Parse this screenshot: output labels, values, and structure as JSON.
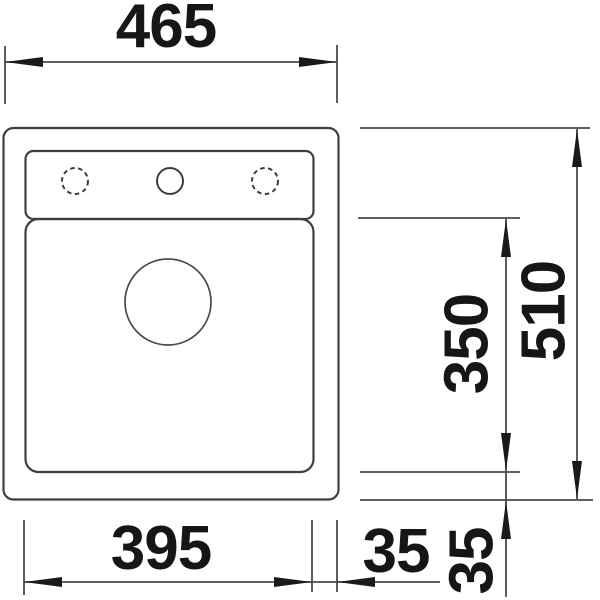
{
  "drawing": {
    "kind": "sink-installation-dimension-drawing",
    "colors": {
      "background": "#ffffff",
      "outline": "#3f3f3f",
      "dimension_lines": "#4a4a4a",
      "text": "#161616"
    },
    "dimensions": {
      "overall_width": {
        "label": "465",
        "orientation": "horizontal",
        "position": "top"
      },
      "overall_depth": {
        "label": "510",
        "orientation": "vertical",
        "position": "right"
      },
      "bowl_depth": {
        "label": "350",
        "orientation": "vertical",
        "position": "right-inner"
      },
      "bowl_width": {
        "label": "395",
        "orientation": "horizontal",
        "position": "bottom"
      },
      "rim_right": {
        "label": "35",
        "orientation": "horizontal",
        "position": "bottom"
      },
      "rim_bottom": {
        "label": "35",
        "orientation": "vertical",
        "position": "bottom-right"
      }
    },
    "features": {
      "tap_holes": [
        {
          "icon": "tap-hole-optional-icon",
          "style": "dashed"
        },
        {
          "icon": "tap-hole-icon",
          "style": "solid"
        },
        {
          "icon": "tap-hole-optional-icon",
          "style": "dashed"
        }
      ],
      "drain": {
        "icon": "drain-hole-icon",
        "style": "solid"
      }
    }
  }
}
